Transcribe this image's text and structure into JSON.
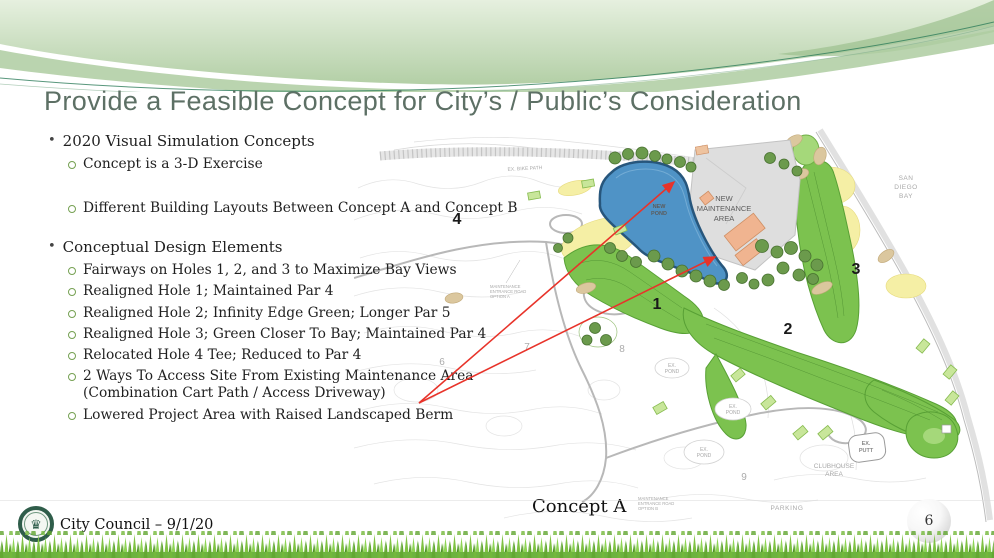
{
  "title": "Provide a Feasible Concept for City’s / Public’s Consideration",
  "bullets": [
    {
      "level": 1,
      "text": "2020 Visual Simulation Concepts"
    },
    {
      "level": 2,
      "text": "Concept is a 3-D Exercise"
    },
    {
      "level": 2,
      "text": "Different Building Layouts Between Concept A and Concept B"
    },
    {
      "level": 1,
      "text": "Conceptual Design Elements"
    },
    {
      "level": 2,
      "text": "Fairways on Holes 1, 2, and 3 to Maximize Bay Views"
    },
    {
      "level": 2,
      "text": "Realigned Hole 1; Maintained Par 4"
    },
    {
      "level": 2,
      "text": "Realigned Hole 2; Infinity Edge Green; Longer Par 5"
    },
    {
      "level": 2,
      "text": "Realigned Hole 3; Green Closer To Bay; Maintained Par 4"
    },
    {
      "level": 2,
      "text": "Relocated Hole 4 Tee; Reduced to Par 4"
    },
    {
      "level": 2,
      "text": "2 Ways To Access Site From Existing Maintenance Area\n(Combination Cart Path / Access Driveway)"
    },
    {
      "level": 2,
      "text": "Lowered Project Area with Raised Landscaped Berm"
    }
  ],
  "map": {
    "caption": "Concept A",
    "labels": {
      "new_pond": [
        "NEW",
        "POND"
      ],
      "new_maintenance_area": [
        "NEW",
        "MAINTENANCE",
        "AREA"
      ],
      "san_diego_bay": [
        "SAN",
        "DIEGO",
        "BAY"
      ],
      "ex_bike_path": "EX. BIKE PATH",
      "ex_pond": [
        "EX.",
        "POND"
      ],
      "ex_putt": [
        "EX.",
        "PUTT"
      ],
      "clubhouse_area": [
        "CLUBHOUSE",
        "AREA"
      ],
      "parking": "PARKING",
      "maint_road_a": [
        "MAINTENANCE",
        "ENTRANCE ROAD",
        "OPTION A"
      ],
      "maint_road_b": [
        "MAINTENANCE",
        "ENTRANCE ROAD",
        "OPTION B"
      ],
      "hole1": "1",
      "hole2": "2",
      "hole3": "3",
      "hole4": "4",
      "ex6": "6",
      "ex7": "7",
      "ex8": "8",
      "ex9": "9"
    }
  },
  "footer": {
    "text": "City Council – 9/1/20",
    "page_number": "6"
  },
  "colors": {
    "title_green": "#5d7065",
    "swoosh_green": "#b7d2aa",
    "fairway_green": "#7cc24f",
    "pond_blue": "#4f93c6",
    "building_salmon": "#f0b490",
    "arrow_red": "#e8332a",
    "seal_green": "#2f5d4a",
    "grass_green": "#6db33f"
  }
}
